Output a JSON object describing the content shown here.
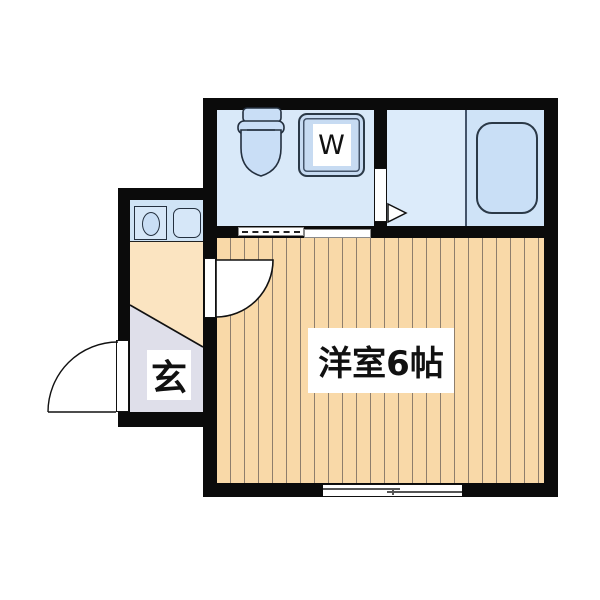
{
  "plan": {
    "type": "japanese-apartment-floor-plan",
    "main_room_label": "洋室6帖",
    "entrance_label": "玄",
    "washer_label": "W",
    "fixtures": [
      "toilet-icon",
      "washing-machine-icon",
      "bathtub-icon",
      "stove-icon",
      "sink-icon"
    ],
    "doors": [
      "entrance-swing-door",
      "interior-swing-door",
      "bathroom-folding-door",
      "sliding-door",
      "sliding-window"
    ],
    "colors": {
      "wall": "#0b0b0b",
      "wet_room": "#D9E9F9",
      "bath_shower": "#DCEBFA",
      "bath_tub_area": "#CFE3F7",
      "fixture_fill": "#C9DFF6",
      "floor_wood": "#F9D9A8",
      "floor_stripe": "#8E7E6C",
      "kitchen_floor": "#FBE4C1",
      "entrance_floor": "#DFDFEA",
      "label_bg": "#FFFFFF",
      "text": "#111111"
    }
  }
}
